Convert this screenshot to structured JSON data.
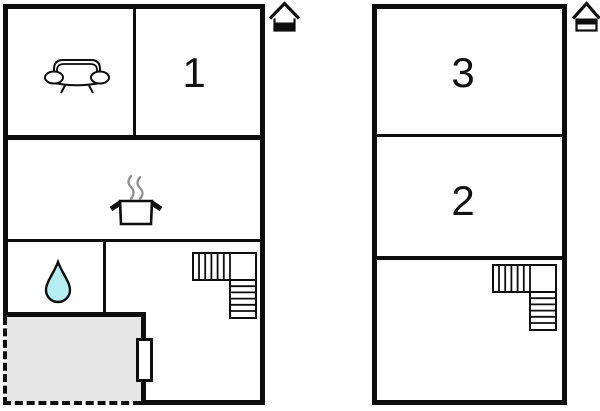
{
  "page": {
    "background": "#ffffff",
    "description": "Two-storey holiday-home floor plan"
  },
  "colors": {
    "wall": "#0d0d0d",
    "room_fill": "#ffffff",
    "terrace_fill": "#e6e6e6",
    "water_drop_fill": "#b4edf2",
    "steam": "#8f8f8f",
    "label_color": "#111111"
  },
  "plans": [
    {
      "id": "ground-floor",
      "floor_indicator": "ground-floor-icon",
      "rooms": [
        {
          "name": "living-room",
          "icon": "sofa-icon",
          "label": ""
        },
        {
          "name": "bedroom-1",
          "label": "1"
        },
        {
          "name": "kitchen",
          "icon": "cooking-pot-icon",
          "label": ""
        },
        {
          "name": "bathroom",
          "icon": "water-drop-icon",
          "label": ""
        },
        {
          "name": "stair-hall",
          "icon": "staircase",
          "label": ""
        },
        {
          "name": "terrace",
          "feature": "dashed-open-side",
          "label": ""
        }
      ],
      "features": [
        "terrace-door"
      ]
    },
    {
      "id": "upper-floor",
      "floor_indicator": "upper-floor-icon",
      "rooms": [
        {
          "name": "bedroom-3",
          "label": "3"
        },
        {
          "name": "bedroom-2",
          "label": "2"
        },
        {
          "name": "landing",
          "icon": "staircase",
          "label": ""
        }
      ]
    }
  ]
}
